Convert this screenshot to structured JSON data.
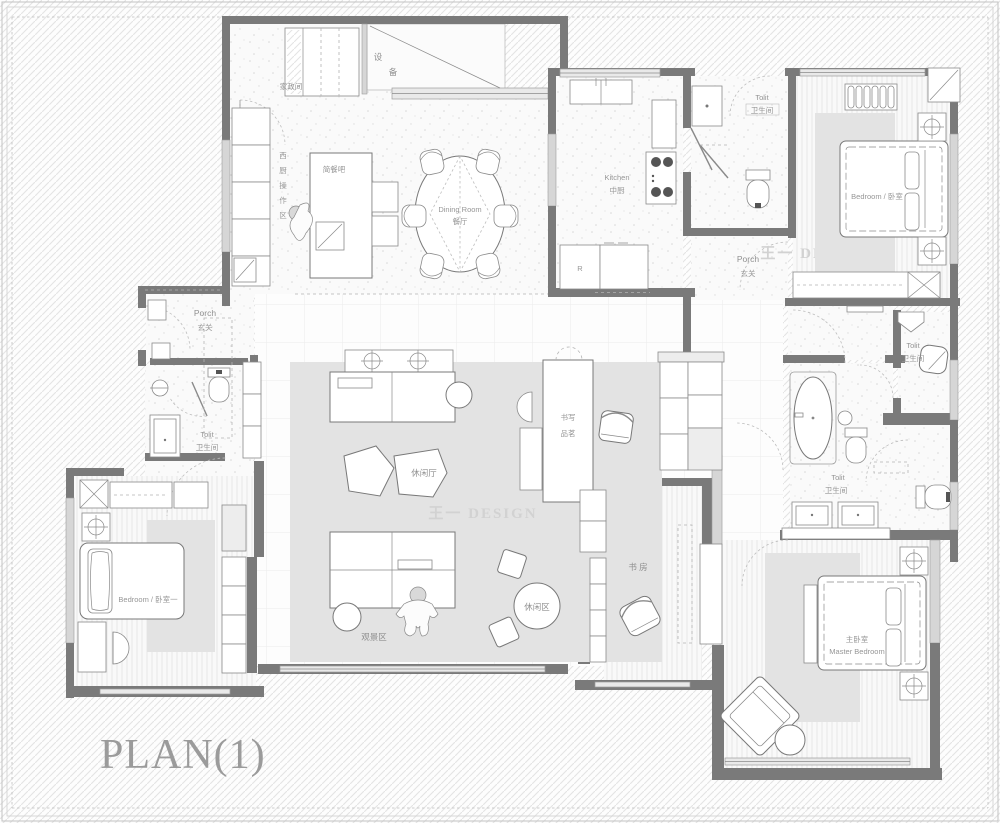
{
  "title": "PLAN(1)",
  "watermark": {
    "text": "王一 DESIGN"
  },
  "rooms": {
    "housekeeping": {
      "zh": "家政间"
    },
    "equipment": {
      "chars": [
        "设",
        "备"
      ]
    },
    "west_kitchen": {
      "chars": [
        "西",
        "厨",
        "操",
        "作",
        "区"
      ]
    },
    "bar": {
      "zh": "简餐吧"
    },
    "dining": {
      "en": "Dining Room",
      "zh": "餐厅"
    },
    "kitchen": {
      "en": "Kitchen",
      "zh": "中厨"
    },
    "fridge": {
      "label": "R"
    },
    "toilet_north": {
      "en": "Tolit",
      "zh": "卫生间"
    },
    "porch_east": {
      "en": "Porch",
      "zh": "玄关"
    },
    "bedroom_north": {
      "label": "Bedroom / 卧室"
    },
    "porch_west": {
      "en": "Porch",
      "zh": "玄关"
    },
    "toilet_west": {
      "en": "Tolit",
      "zh": "卫生间"
    },
    "bedroom_west": {
      "label": "Bedroom / 卧室一"
    },
    "lounge": {
      "zh": "休闲厅"
    },
    "viewing": {
      "zh": "观景区"
    },
    "leisure": {
      "zh": "休闲区"
    },
    "tea": {
      "line1": "书写",
      "line2": "品茗"
    },
    "study": {
      "zh": "书 房"
    },
    "toilet_east_small": {
      "en": "Tolit",
      "zh": "卫生间"
    },
    "toilet_east": {
      "en": "Tolit",
      "zh": "卫生间"
    },
    "master": {
      "zh": "主卧室",
      "en": "Master Bedroom"
    }
  },
  "colors": {
    "wall": "#7a7a7a",
    "light_wall": "#d6d6d6",
    "rug": "#e3e3e3",
    "label": "#8f8f8f",
    "watermark": "#d2d2d2",
    "hatch": "#e4e4e4"
  }
}
